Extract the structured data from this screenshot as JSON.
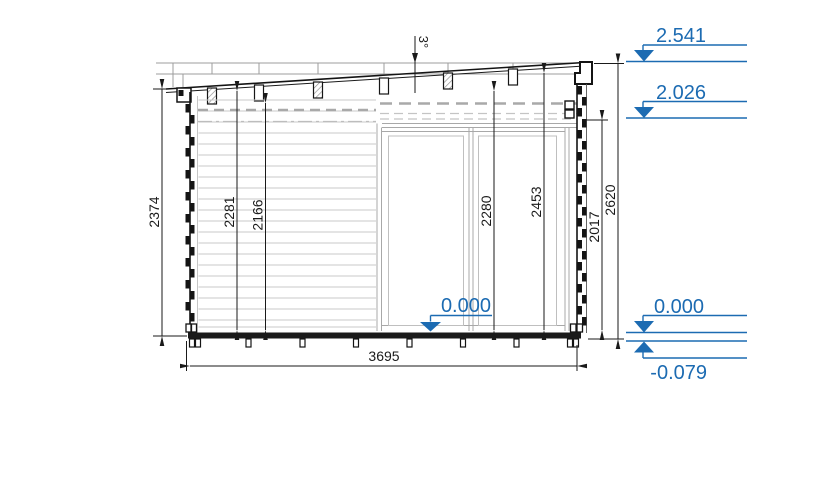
{
  "drawing": {
    "title_hint": "side elevation of log cabin with pent roof",
    "angle_label": "3°",
    "dims": {
      "height_left_outer": "2374",
      "wall_inner_1": "2281",
      "wall_inner_2": "2166",
      "opening_mid": "2280",
      "inner_right": "2453",
      "door_right": "2017",
      "height_right_outer": "2620",
      "overall_width": "3695"
    },
    "levels": {
      "roof_top": "2.541",
      "wall_top": "2.026",
      "floor_mid": "0.000",
      "floor_right": "0.000",
      "ground": "-0.079"
    },
    "colors": {
      "accent_blue": "#1c6bb2",
      "line_black": "#1a1a1a"
    }
  }
}
